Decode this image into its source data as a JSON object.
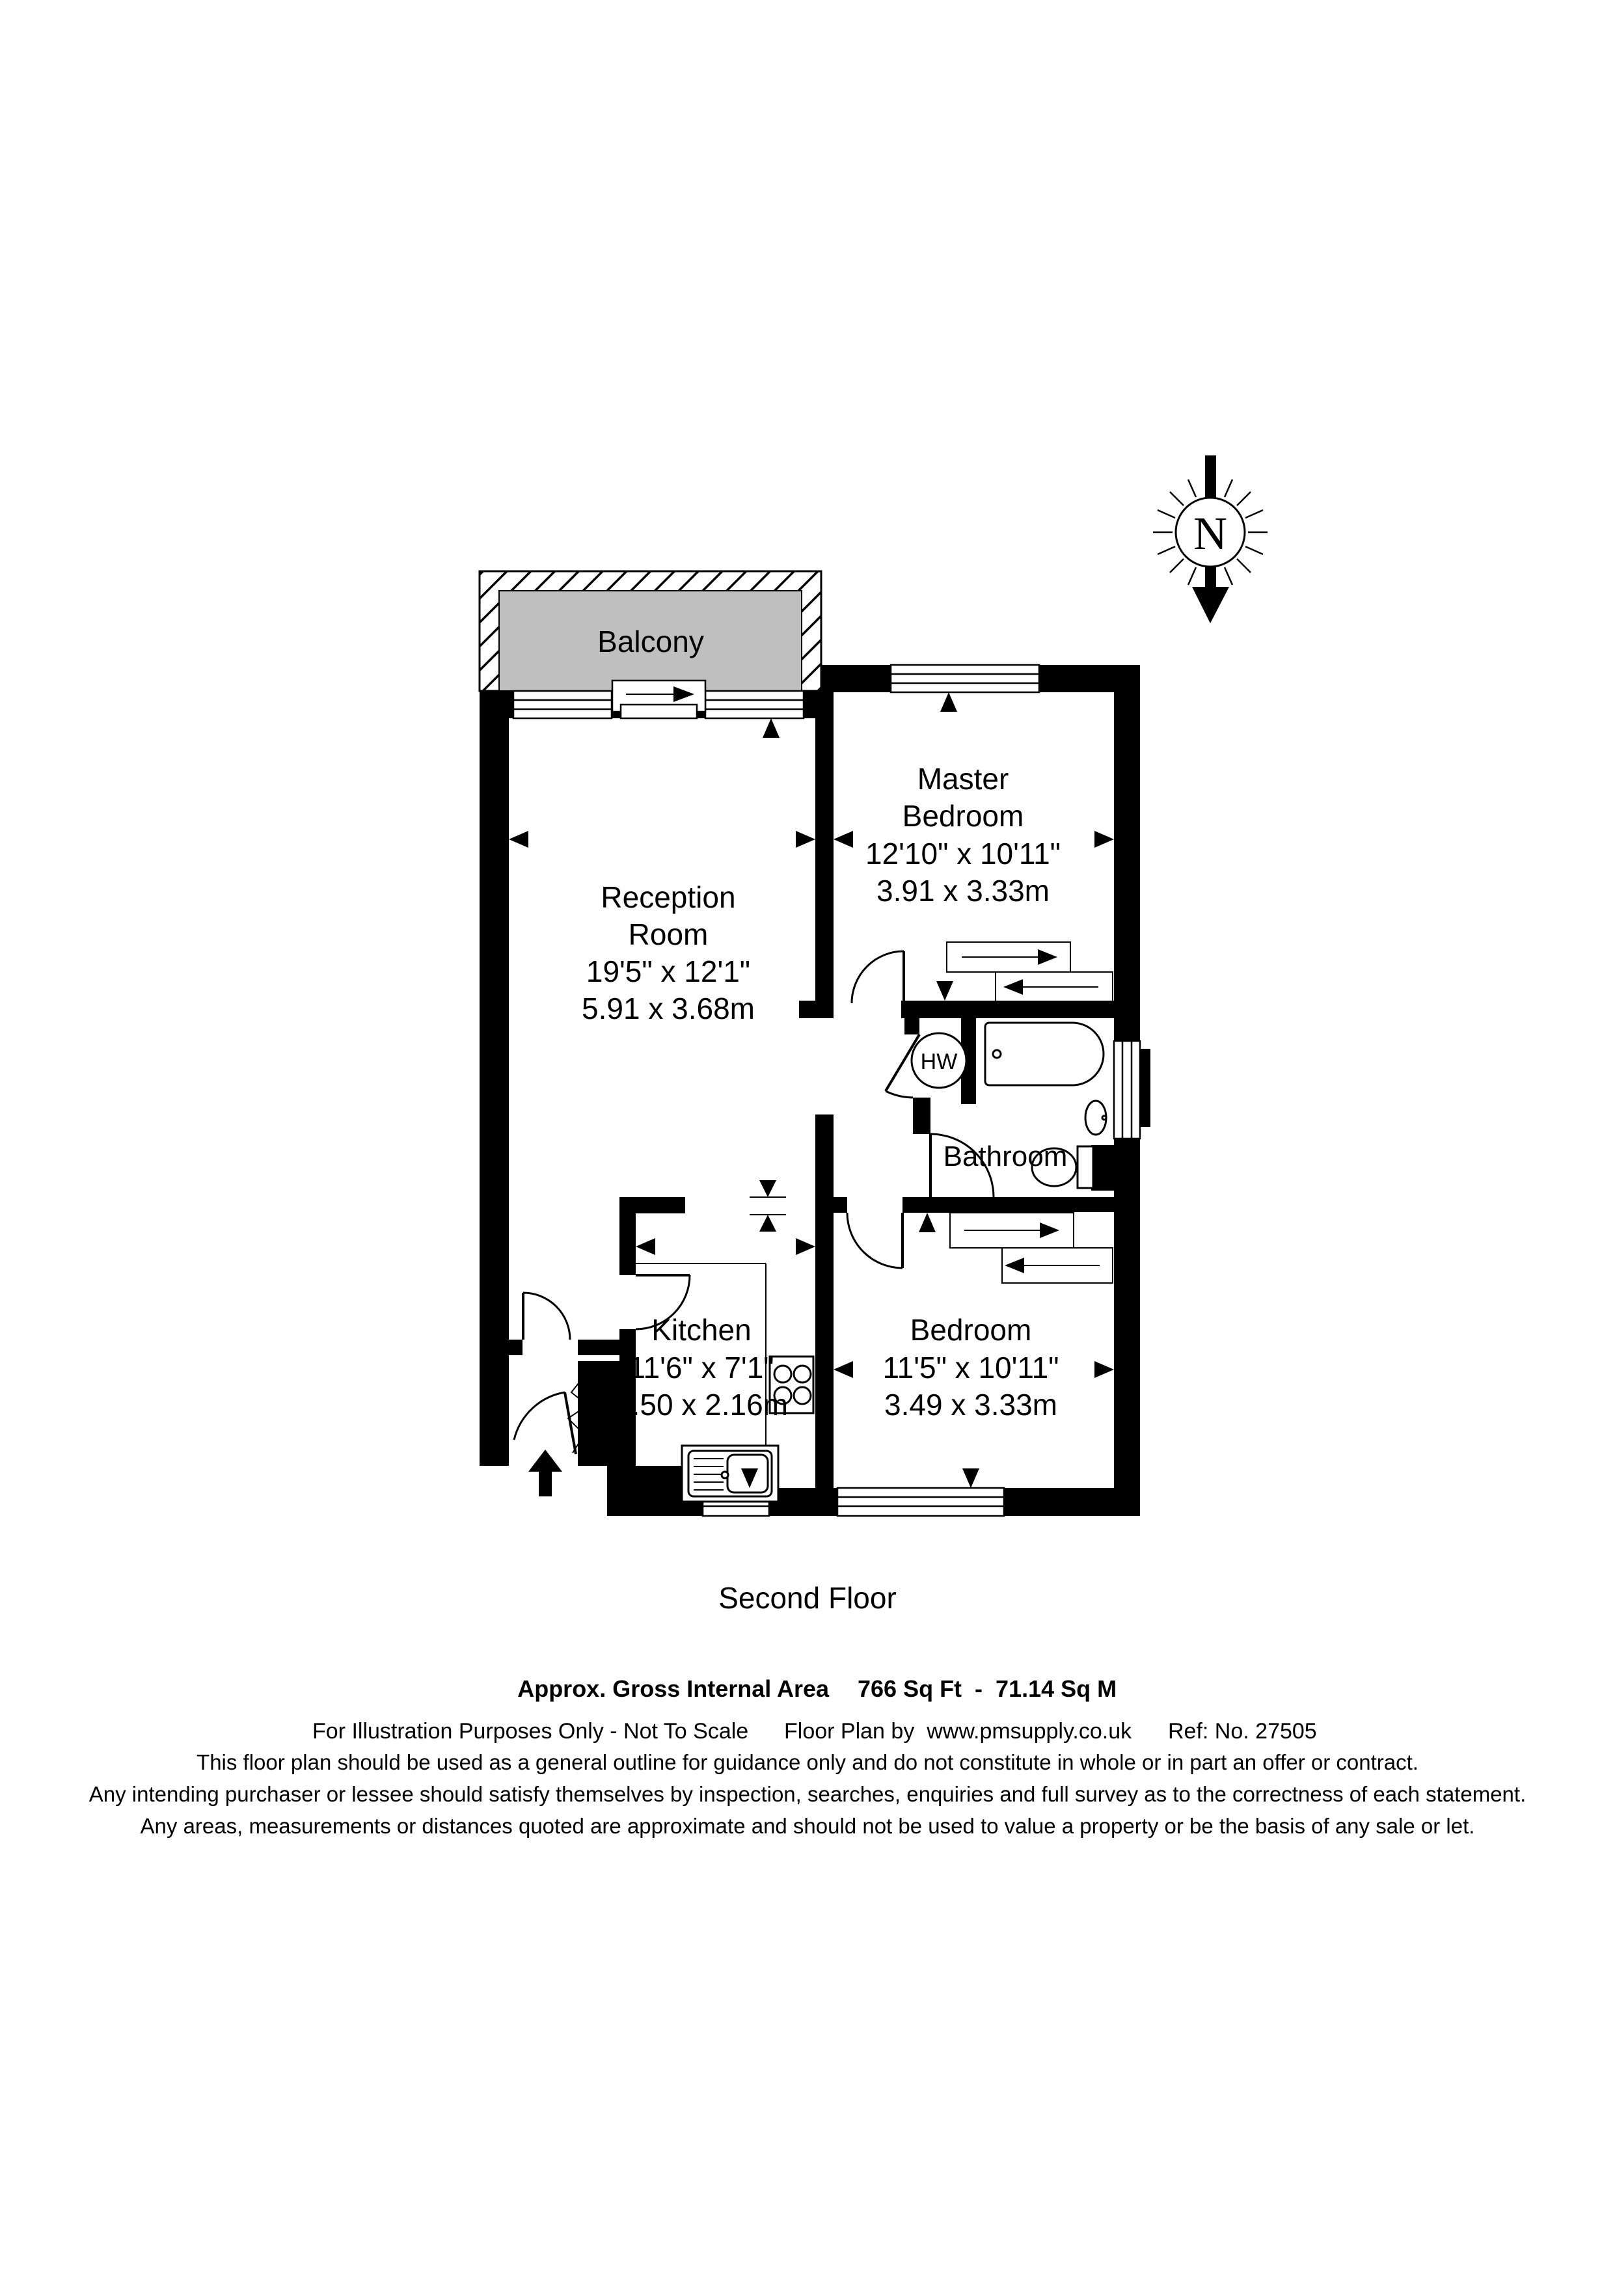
{
  "compass": {
    "label": "N"
  },
  "balcony": {
    "label": "Balcony"
  },
  "rooms": {
    "reception": {
      "name_line1": "Reception",
      "name_line2": "Room",
      "size_imperial": "19'5\" x 12'1\"",
      "size_metric": "5.91 x 3.68m"
    },
    "master_bedroom": {
      "name_line1": "Master",
      "name_line2": "Bedroom",
      "size_imperial": "12'10\" x 10'11\"",
      "size_metric": "3.91 x 3.33m"
    },
    "kitchen": {
      "name_line1": "Kitchen",
      "size_imperial": "11'6\" x 7'1\"",
      "size_metric": "3.50 x 2.16m"
    },
    "bedroom": {
      "name_line1": "Bedroom",
      "size_imperial": "11'5\" x 10'11\"",
      "size_metric": "3.49 x 3.33m"
    },
    "bathroom": {
      "name_line1": "Bathroom"
    },
    "hot_water": {
      "label": "HW"
    }
  },
  "footer": {
    "floor_label": "Second Floor",
    "area_label": "Approx. Gross Internal Area",
    "area_value": "766 Sq Ft  -  71.14 Sq M",
    "illustration_note": "For Illustration Purposes Only - Not To Scale",
    "credit": "Floor Plan by  www.pmsupply.co.uk",
    "reference": "Ref: No. 27505",
    "disclaimer_line1": "This floor plan should be used as a general outline for guidance only and do not constitute in whole or in part an offer or contract.",
    "disclaimer_line2": "Any intending purchaser or lessee should satisfy themselves by inspection, searches, enquiries and full survey as to the correctness of each statement.",
    "disclaimer_line3": "Any areas, measurements or distances quoted are approximate and should not be used to value a property or be the basis of any sale or let."
  },
  "colors": {
    "wall": "#000000",
    "balcony_fill": "#bfbfbf",
    "background": "#ffffff"
  }
}
